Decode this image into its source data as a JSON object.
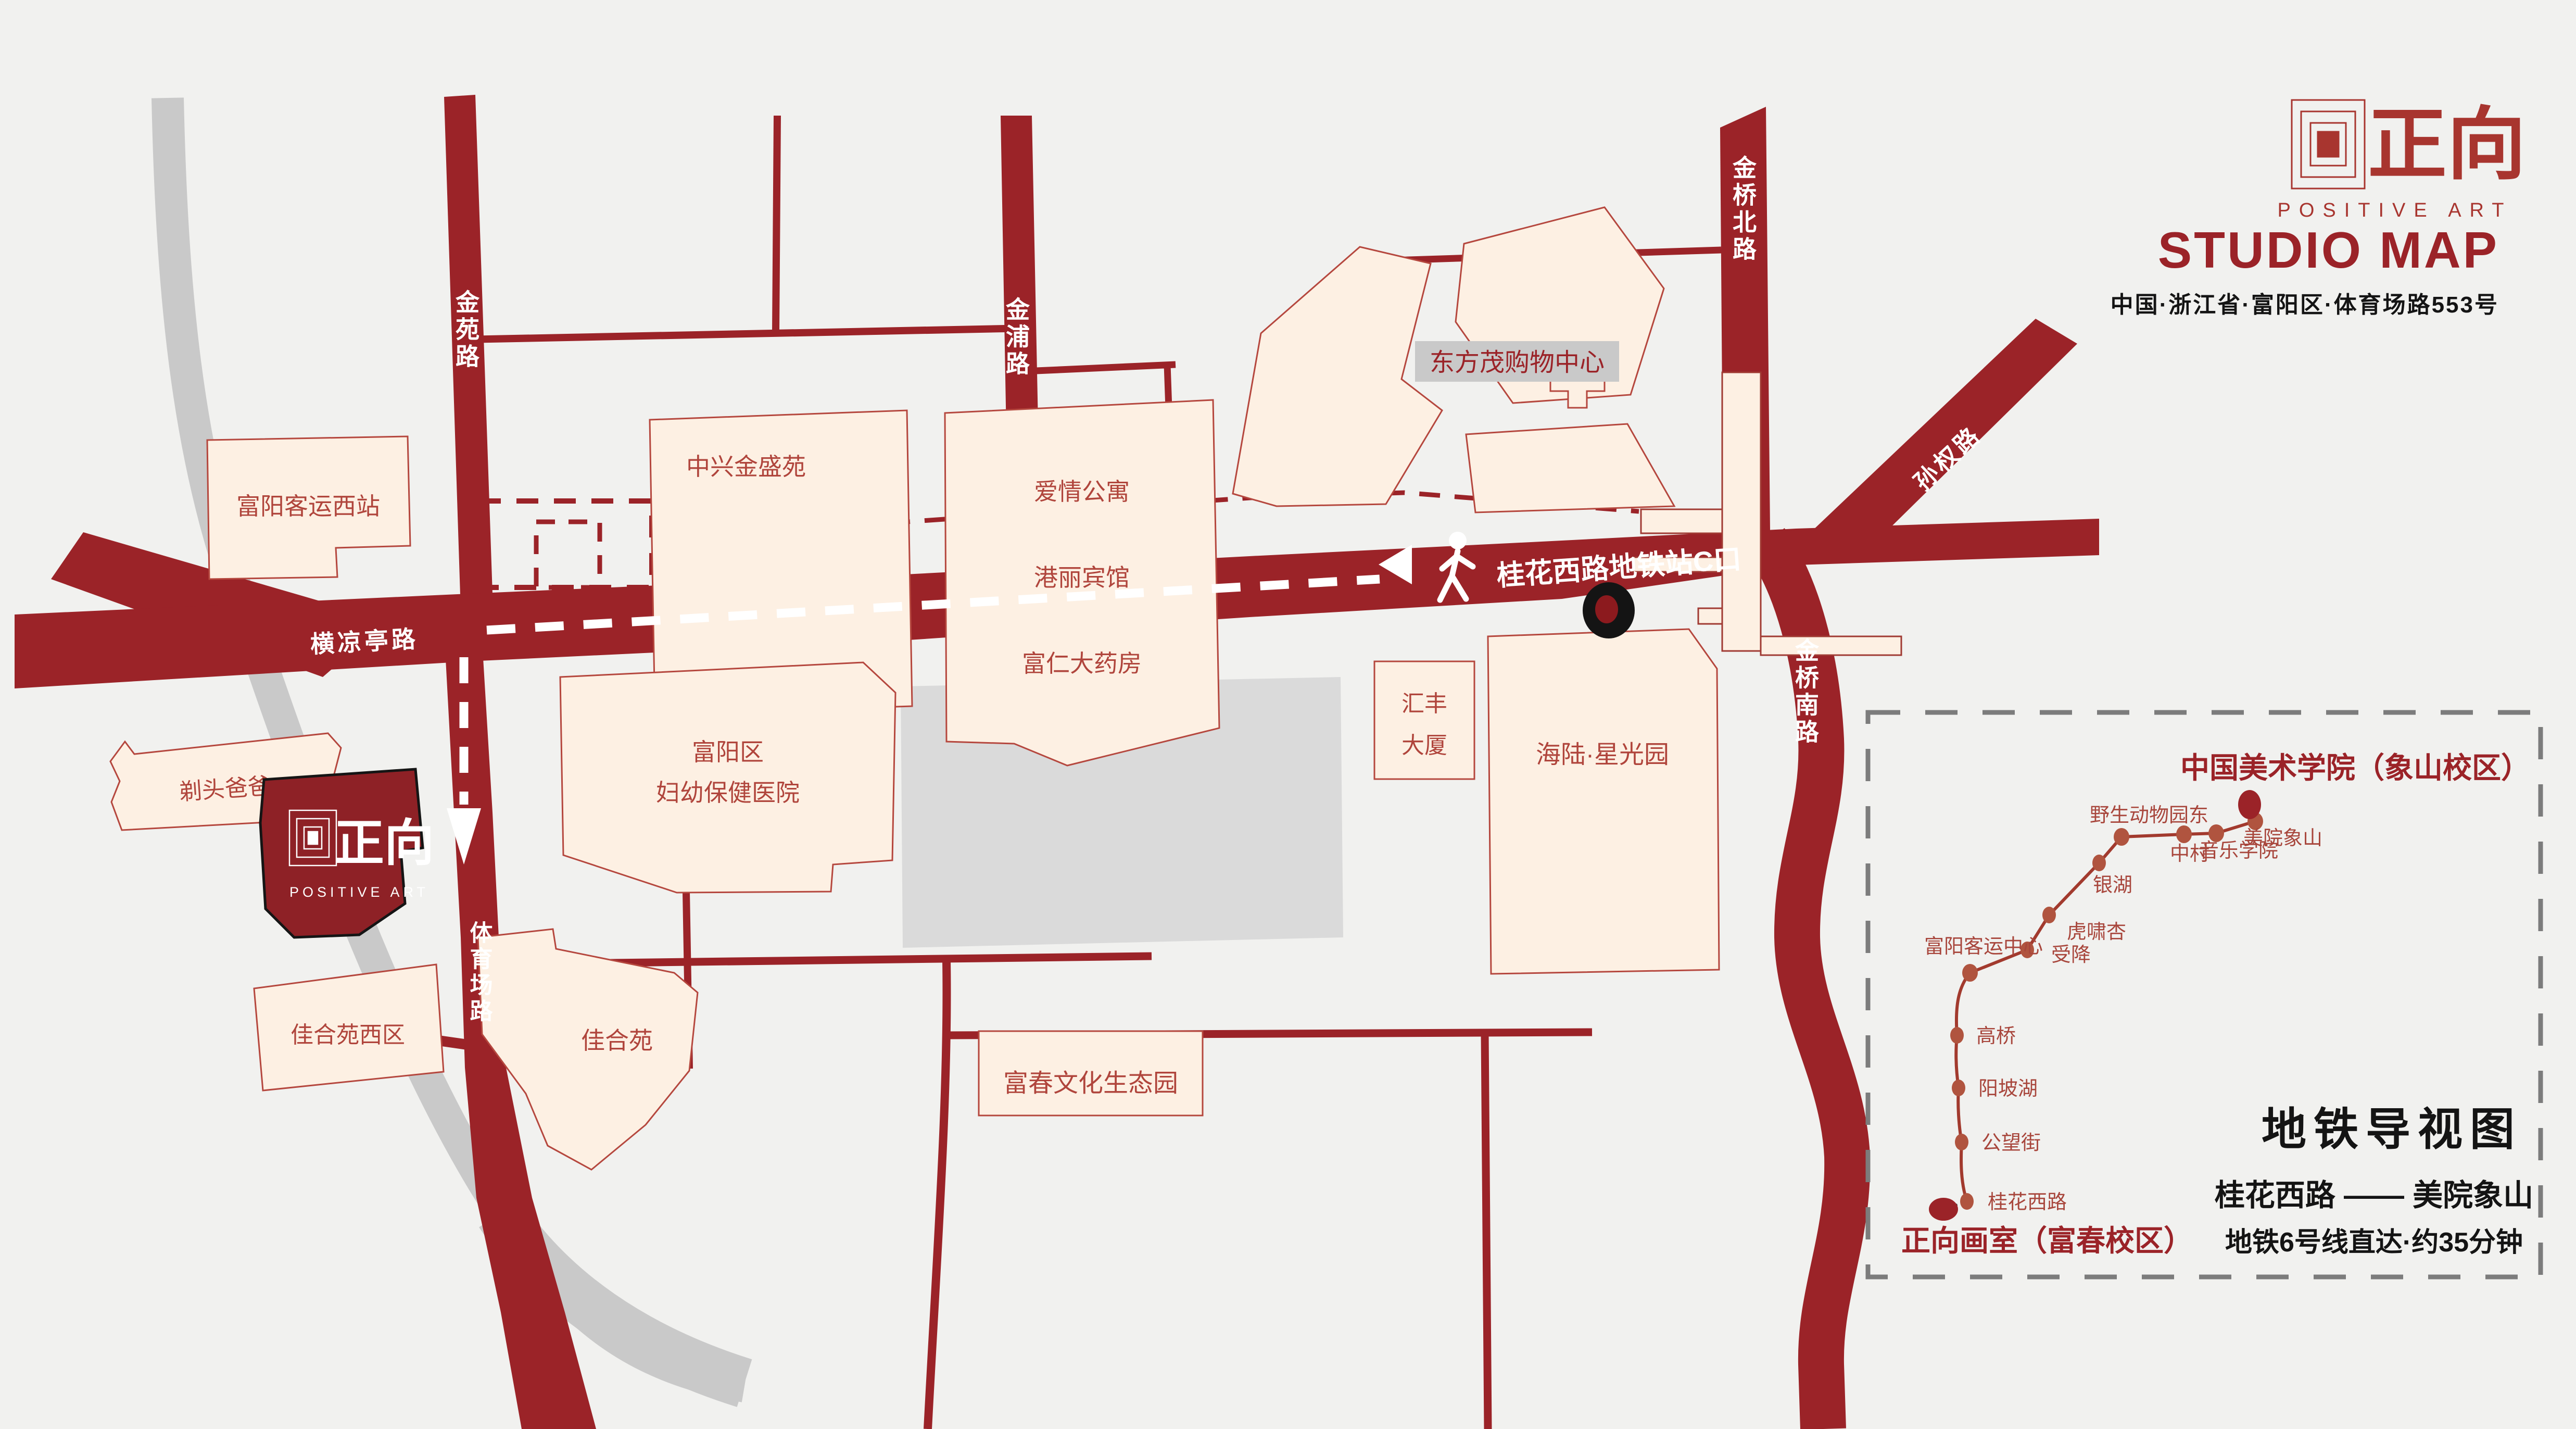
{
  "header": {
    "logo_zh": "正向",
    "logo_en": "POSITIVE ART",
    "title": "STUDIO MAP",
    "address": "中国·浙江省·富阳区·体育场路553号"
  },
  "colors": {
    "background": "#f1f1ef",
    "road_red": "#9b2328",
    "building_fill": "#fdf0e3",
    "building_stroke": "#b5473e",
    "studio_red": "#8e2126",
    "river_gray": "#c9c9c9",
    "block_gray": "#dadada",
    "panel_border_gray": "#7c7c7c",
    "metro_line": "#a23a2e",
    "station_dot": "#b0543f",
    "text_black": "#141414"
  },
  "map": {
    "roads": {
      "jinyuan": "金苑路",
      "jinpu": "金浦路",
      "jinqiao_north": "金桥北路",
      "sunquan": "孙权路",
      "jinqiao_south": "金桥南路",
      "hengliangting": "横凉亭路",
      "tiyuchang": "体育场路",
      "metro_exit": "桂花西路地铁站C口"
    },
    "buildings": {
      "west_station": "富阳客运西站",
      "zhongxing": "中兴金盛苑",
      "love_apartment": "爱情公寓",
      "gangli_hotel": "港丽宾馆",
      "furen_pharmacy": "富仁大药房",
      "dongfangmao": "东方茂购物中心",
      "titou_daddy": "剃头爸爸",
      "huifeng_1": "汇丰",
      "huifeng_2": "大厦",
      "hailu": "海陆·星光园",
      "hospital_1": "富阳区",
      "hospital_2": "妇幼保健医院",
      "jiaheyuan_west": "佳合苑西区",
      "jiaheyuan": "佳合苑",
      "fuchun_park": "富春文化生态园"
    },
    "studio": {
      "logo_zh": "正向",
      "logo_en": "POSITIVE ART"
    }
  },
  "metro_panel": {
    "title": "地铁导视图",
    "route": "桂花西路 —— 美院象山",
    "note": "地铁6号线直达·约35分钟",
    "endpoint_top": "中国美术学院（象山校区）",
    "endpoint_bottom": "正向画室（富春校区）",
    "stations": [
      "桂花西路",
      "公望街",
      "阳坡湖",
      "高桥",
      "富阳客运中心",
      "受降",
      "虎啸杏",
      "银湖",
      "野生动物园东",
      "中村",
      "音乐学院",
      "美院象山"
    ]
  }
}
